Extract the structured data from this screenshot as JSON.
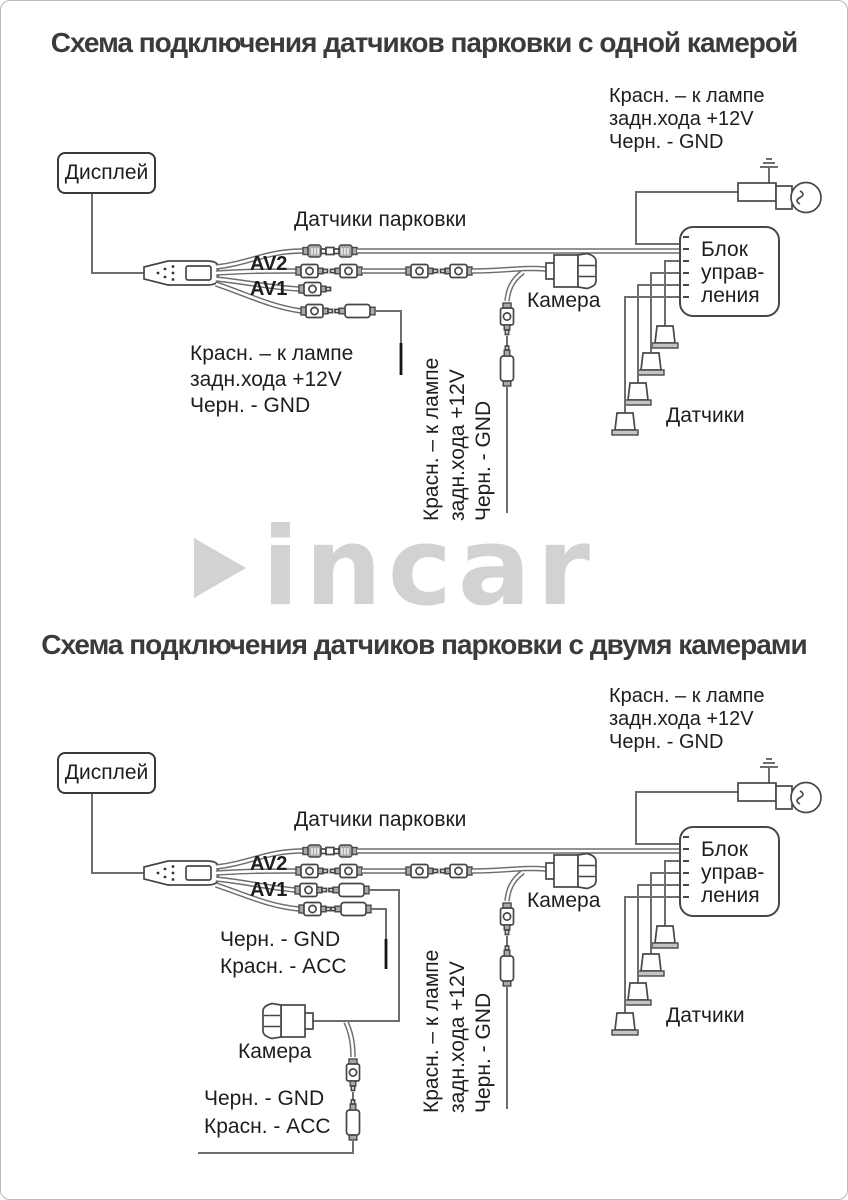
{
  "colors": {
    "title": "#3b3b3b",
    "label": "#1e1e1e",
    "wire": "#6e6e6e",
    "logo_gray": "#d2d2d2"
  },
  "logo": {
    "text": "incar"
  },
  "d1": {
    "title": "Схема подключения датчиков парковки с одной камерой",
    "display_label": "Дисплей",
    "unit_lines": [
      "Блок",
      "управ-",
      "ления"
    ],
    "parking_cable_label": "Датчики парковки",
    "av2_label": "AV2",
    "av1_label": "AV1",
    "camera_label": "Камера",
    "sensors_label": "Датчики",
    "note_lamp": [
      "Красн. – к лампе",
      "задн.хода +12V",
      "Черн. - GND"
    ],
    "note_av_power": [
      "Красн. – к лампе",
      "задн.хода +12V",
      "Черн. - GND"
    ],
    "note_camera_power": [
      "Красн. – к лампе",
      "задн.хода +12V",
      "Черн. - GND"
    ]
  },
  "d2": {
    "title": "Схема подключения датчиков парковки с двумя камерами",
    "display_label": "Дисплей",
    "unit_lines": [
      "Блок",
      "управ-",
      "ления"
    ],
    "parking_cable_label": "Датчики парковки",
    "av2_label": "AV2",
    "av1_label": "AV1",
    "camera_rear_label": "Камера",
    "camera_front_label": "Камера",
    "sensors_label": "Датчики",
    "note_lamp": [
      "Красн. – к лампе",
      "задн.хода +12V",
      "Черн. - GND"
    ],
    "note_av1_power": [
      "Черн. - GND",
      "Красн. - ACC"
    ],
    "note_camera_front_power": [
      "Черн. - GND",
      "Красн. - ACC"
    ],
    "note_camera_rear_power": [
      "Красн. – к лампе",
      "задн.хода +12V",
      "Черн. - GND"
    ]
  }
}
